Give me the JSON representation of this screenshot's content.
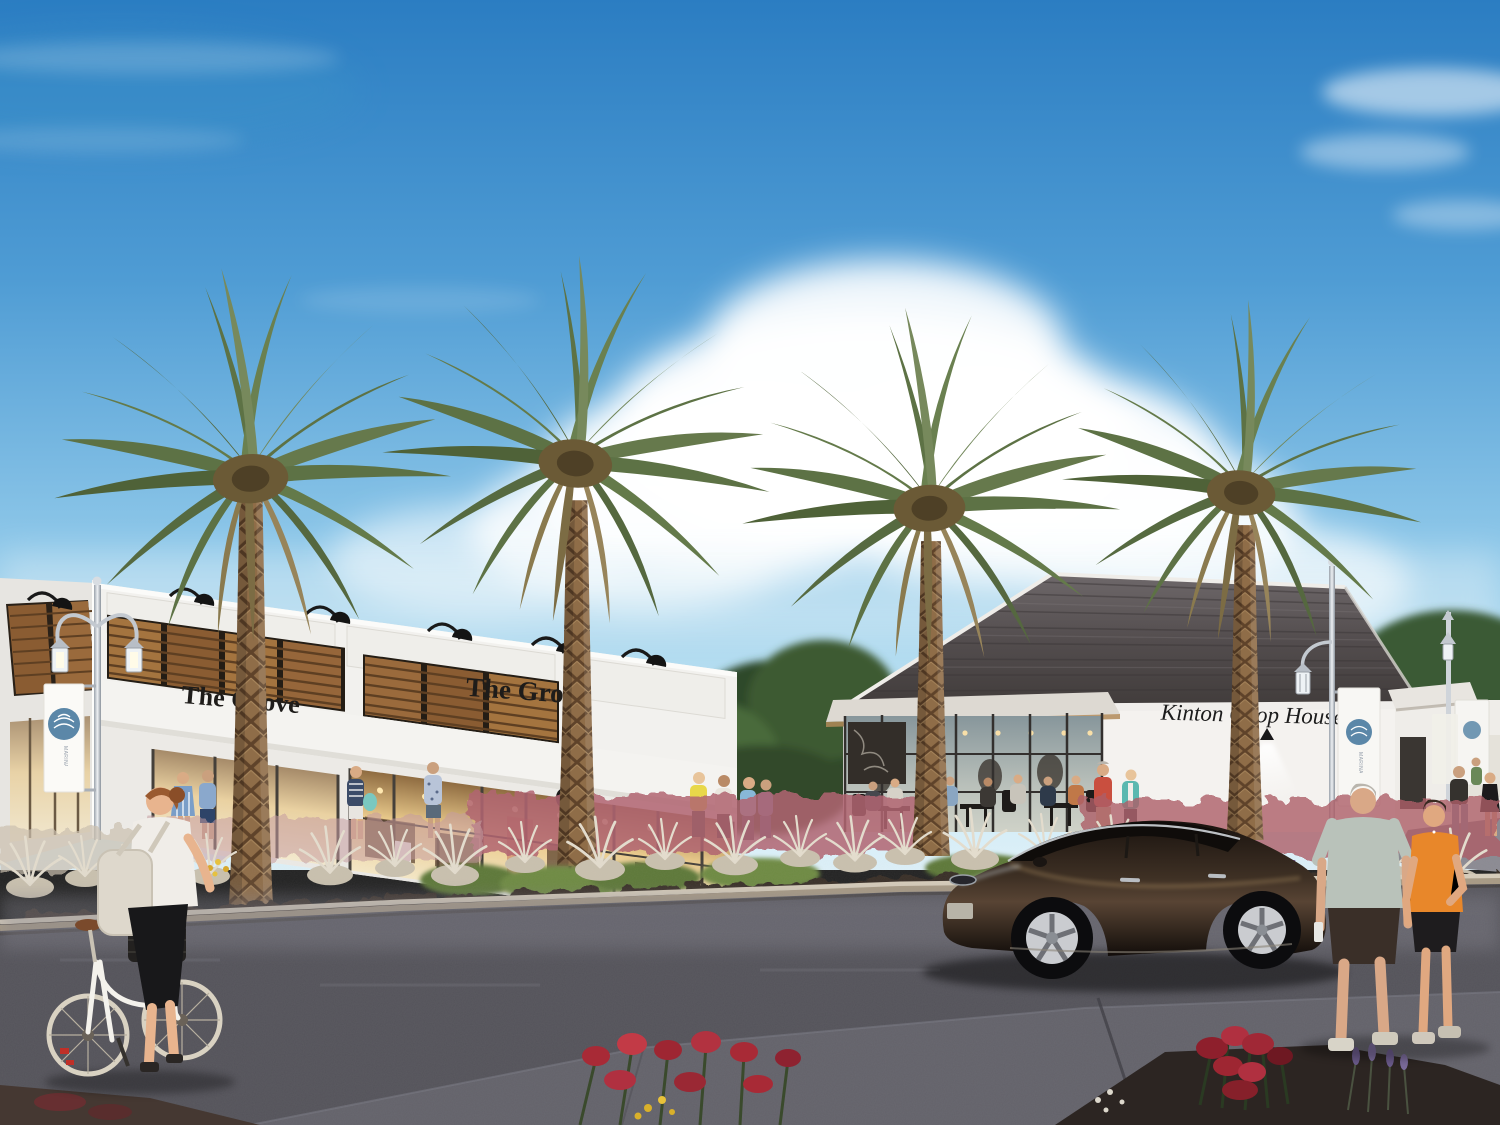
{
  "scene": {
    "type": "architectural rendering of a retail plaza streetscape with date palms",
    "signs": {
      "grove_left": "The Grove",
      "grove_right": "The Grove",
      "chop_house": "Kinton Chop House"
    },
    "banners": {
      "text": "MARINA LANDINGS"
    },
    "colors": {
      "sky_top": "#2b7dc2",
      "sky_horizon": "#d8eef7",
      "building_white": "#f2f1ee",
      "roof_shingle": "#4a4443",
      "shutter_wood": "#9a6a3c",
      "banner_logo_blue": "#5b87a8",
      "palm_frond_green": "#66794c",
      "palm_trunk_brown": "#8a6844",
      "asphalt": "#54535a",
      "grass_plume_pink": "#b06572",
      "car_paint": "#231b15",
      "orange_tank_top": "#e8872a",
      "red_shirt": "#c94f3f"
    }
  }
}
